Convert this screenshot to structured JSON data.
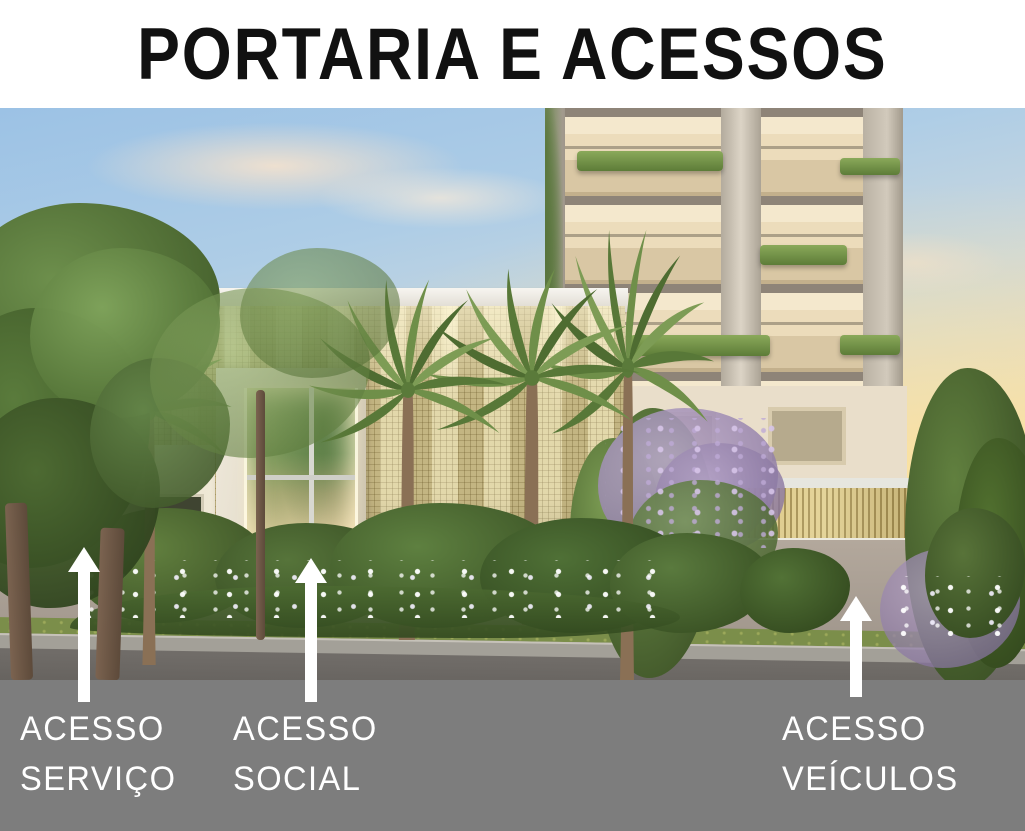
{
  "header": {
    "title": "PORTARIA E ACESSOS"
  },
  "caption_bar": {
    "labels": [
      {
        "id": "servico",
        "lines": [
          "ACESSO",
          "SERVIÇO"
        ],
        "arrow_icon": "up-arrow"
      },
      {
        "id": "social",
        "lines": [
          "ACESSO",
          "SOCIAL"
        ],
        "arrow_icon": "up-arrow"
      },
      {
        "id": "veiculos",
        "lines": [
          "ACESSO",
          "VEÍCULOS"
        ],
        "arrow_icon": "up-arrow"
      }
    ]
  },
  "colors": {
    "title_text": "#111111",
    "caption_bar_bg": "#7d7d7d",
    "label_text": "#ffffff",
    "arrow": "#ffffff",
    "lattice_gold": "#d9cc98",
    "slat_gold": "#c9b472",
    "sky_blue": "#9cc2e5",
    "sunset_glow": "#f8e5ab",
    "foliage_green": "#5d7c3c",
    "stone": "#e8e2d2"
  }
}
